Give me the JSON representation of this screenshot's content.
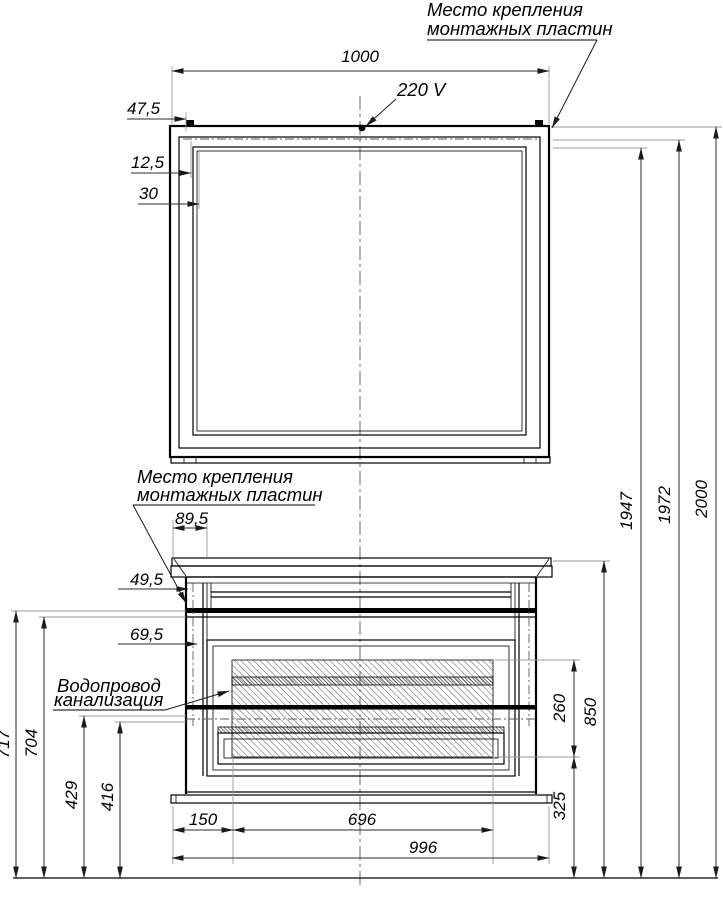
{
  "labels": {
    "mounting_plates_line1": "Место крепления",
    "mounting_plates_line2": "монтажных пластин",
    "power": "220 V",
    "plumbing_line1": "Водопровод",
    "plumbing_line2": "канализация"
  },
  "dimensions": {
    "mirror_width": "1000",
    "plate_offset_top": "47,5",
    "frame_inset_small": "12,5",
    "frame_inset_large": "30",
    "cabinet_plate_offset": "89,5",
    "cabinet_plate_side": "49,5",
    "cabinet_niche_offset": "69,5",
    "height_717": "717",
    "height_704": "704",
    "height_429": "429",
    "height_416": "416",
    "bottom_150": "150",
    "bottom_696": "696",
    "bottom_996": "996",
    "right_260": "260",
    "right_850": "850",
    "right_325": "325",
    "overall_1947": "1947",
    "overall_1972": "1972",
    "overall_2000": "2000"
  }
}
